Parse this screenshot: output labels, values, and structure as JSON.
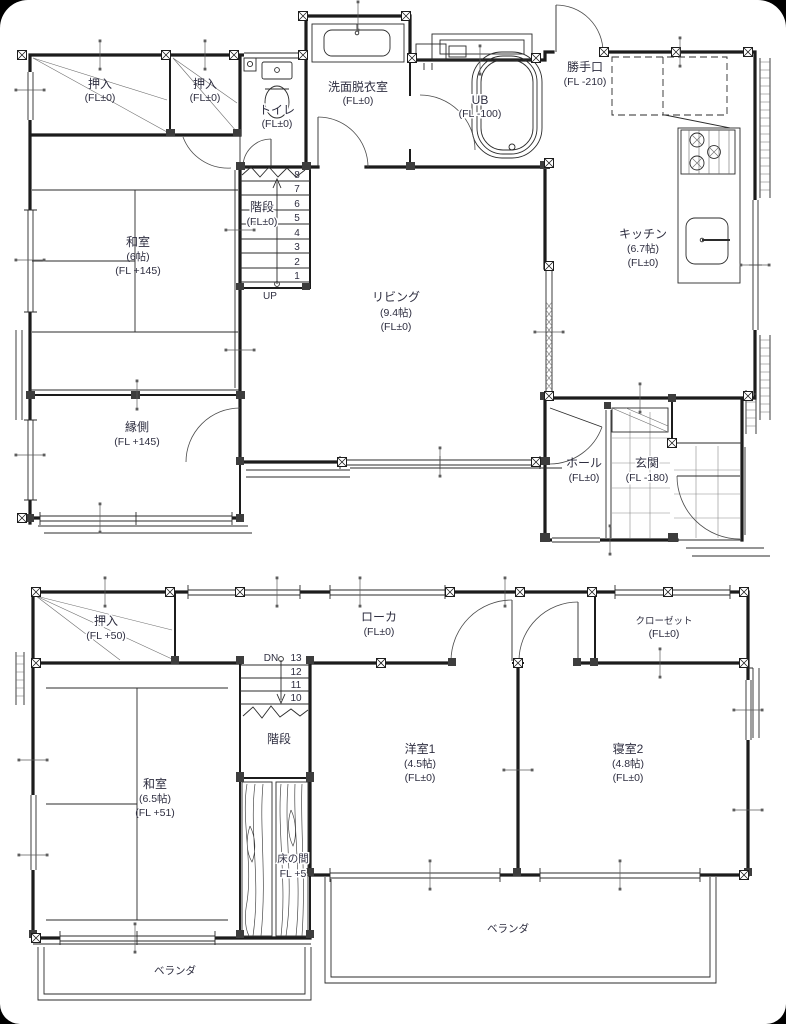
{
  "f1": {
    "oshiire_left": {
      "name": "押入",
      "fl": "(FL±0)"
    },
    "oshiire_right": {
      "name": "押入",
      "fl": "(FL±0)"
    },
    "toilet": {
      "name": "トイレ",
      "fl": "(FL±0)"
    },
    "washroom": {
      "name": "洗面脱衣室",
      "fl": "(FL±0)"
    },
    "bath": {
      "name": "UB",
      "fl": "(FL -100)"
    },
    "backdoor": {
      "name": "勝手口",
      "fl": "(FL -210)"
    },
    "kitchen": {
      "name": "キッチン",
      "size": "(6.7帖)",
      "fl": "(FL±0)"
    },
    "washitsu": {
      "name": "和室",
      "size": "(6帖)",
      "fl": "(FL +145)"
    },
    "stairs": {
      "name": "階段",
      "fl": "(FL±0)",
      "direction": "UP",
      "steps": [
        "8",
        "7",
        "6",
        "5",
        "4",
        "3",
        "2",
        "1"
      ]
    },
    "living": {
      "name": "リビング",
      "size": "(9.4帖)",
      "fl": "(FL±0)"
    },
    "engawa": {
      "name": "縁側",
      "fl": "(FL +145)"
    },
    "hall": {
      "name": "ホール",
      "fl": "(FL±0)"
    },
    "genkan": {
      "name": "玄関",
      "fl": "(FL -180)"
    }
  },
  "f2": {
    "oshiire": {
      "name": "押入",
      "fl": "(FL +50)"
    },
    "roka": {
      "name": "ローカ",
      "fl": "(FL±0)"
    },
    "closet": {
      "name": "クローゼット",
      "fl": "(FL±0)"
    },
    "stairs": {
      "name": "階段",
      "direction": "DN",
      "steps": [
        "13",
        "12",
        "11",
        "10"
      ]
    },
    "washitsu": {
      "name": "和室",
      "size": "(6.5帖)",
      "fl": "(FL +51)"
    },
    "tokonoma": {
      "name": "床の間",
      "fl": "FL +5"
    },
    "yoshitsu1": {
      "name": "洋室1",
      "size": "(4.5帖)",
      "fl": "(FL±0)"
    },
    "shinshitsu2": {
      "name": "寝室2",
      "size": "(4.8帖)",
      "fl": "(FL±0)"
    },
    "veranda_left": {
      "name": "ベランダ"
    },
    "veranda_right": {
      "name": "ベランダ"
    }
  }
}
